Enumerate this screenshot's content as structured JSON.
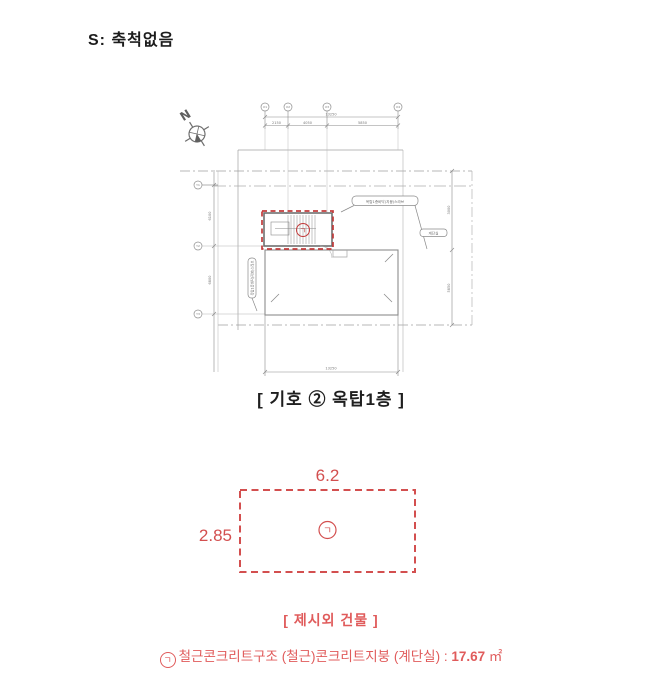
{
  "page": {
    "scale_note": "S: 축척없음"
  },
  "plan": {
    "caption": "[ 기호 ② 옥탑1층 ]",
    "north_label": "N",
    "grid_bubbles_top": [
      "X1",
      "X2",
      "X3",
      "X4"
    ],
    "grid_bubbles_left": [
      "Y1",
      "Y2",
      "Y3"
    ],
    "dims": {
      "top_total": "13250",
      "top_seg1": "2150",
      "top_seg2": "4050",
      "top_seg3": "5850",
      "bottom_total": "13250",
      "left_seg1": "6100",
      "left_seg2": "6800",
      "right_seg1": "3000",
      "right_seg2": "5850"
    },
    "labels": {
      "roof_balloon": "옥탑1층바닥(지붕)스라브",
      "left_balloon": "옥탑1층바닥(지붕)스라브",
      "right_tag": "계단실",
      "unit_symbol": "ㄱ"
    }
  },
  "annex": {
    "width_label": "6.2",
    "height_label": "2.85",
    "unit_symbol": "ㄱ",
    "caption": "[ 제시외 건물 ]"
  },
  "footer": {
    "symbol": "ㄱ",
    "description": "철근콘크리트구조 (철근)콘크리트지붕 (계단실) : ",
    "area_value": "17.67",
    "area_unit": "㎡"
  },
  "colors": {
    "drawing_line_gray": "#8f8f8f",
    "highlight_red": "#c23b3b",
    "annex_red": "#d34f4f",
    "text_red": "#e05b5b",
    "text_black": "#1c1c1c"
  }
}
